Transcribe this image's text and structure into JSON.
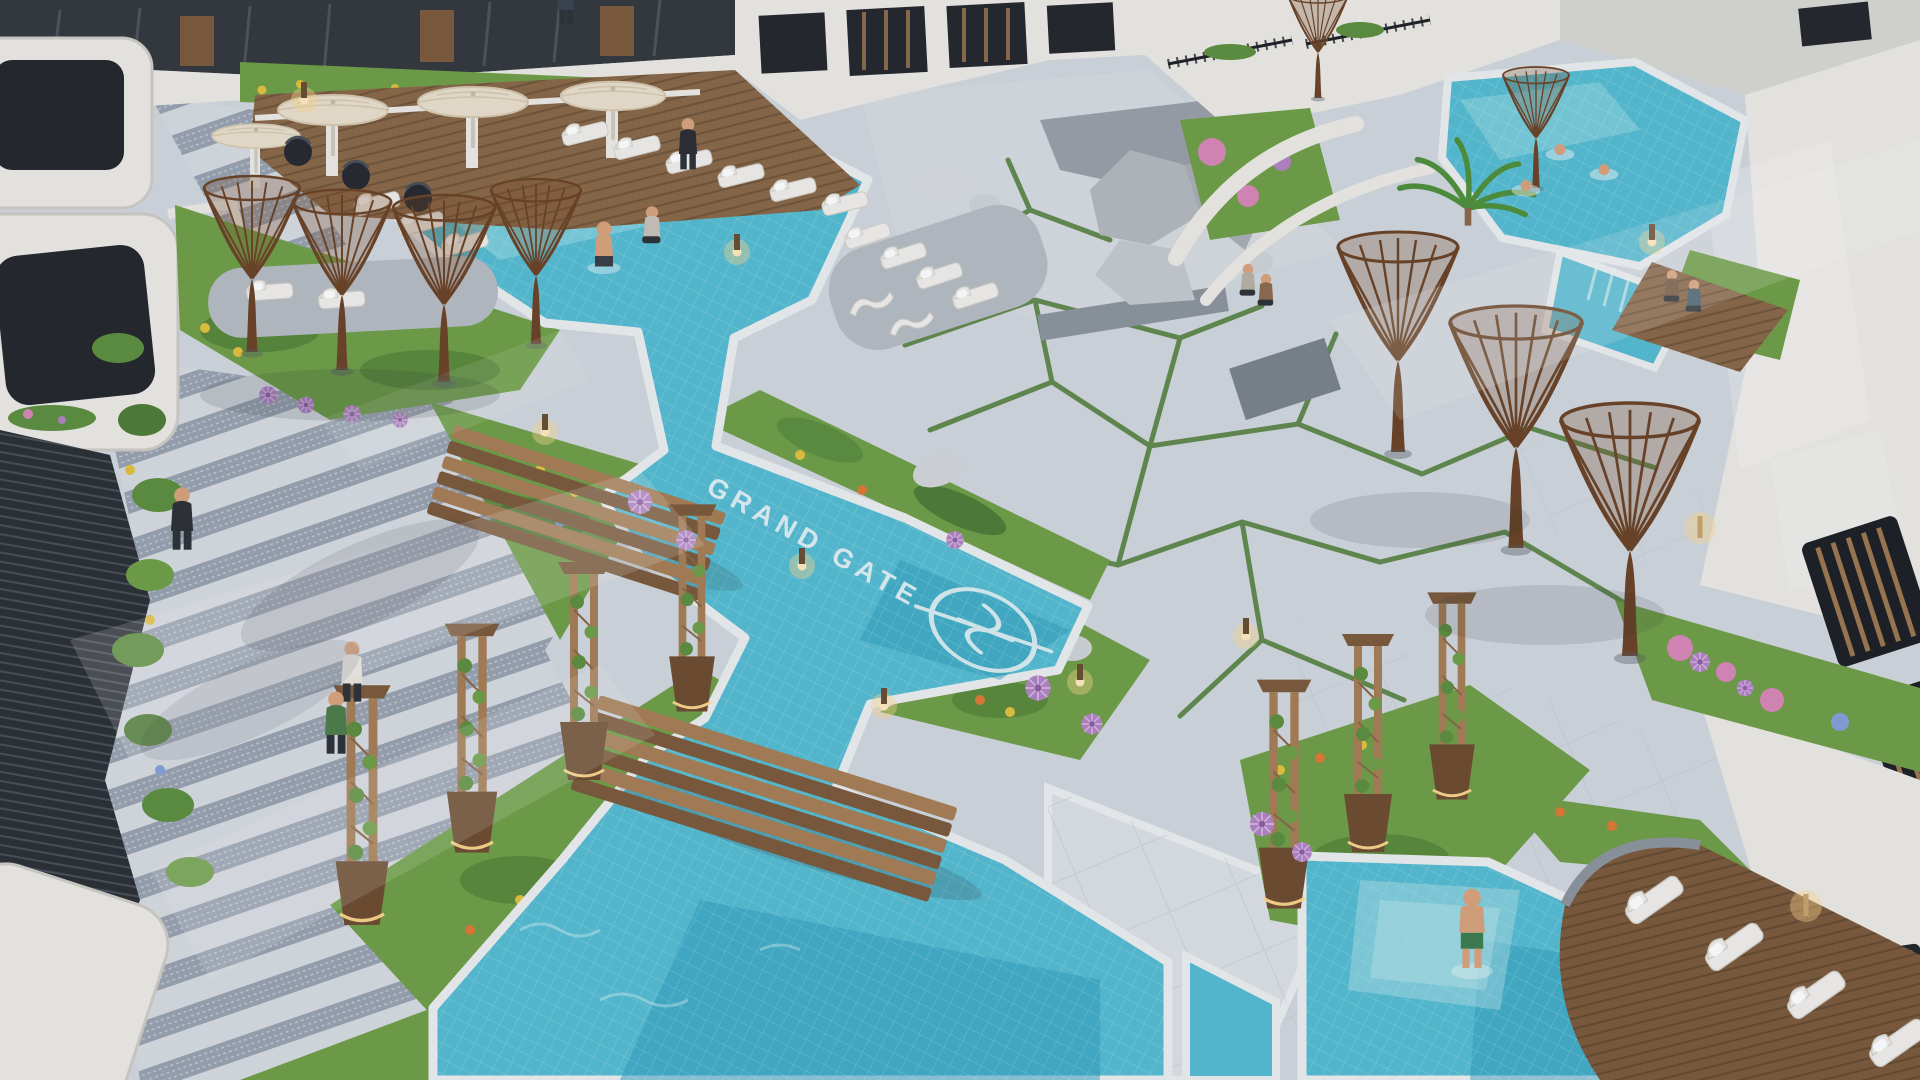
{
  "meta": {
    "type": "architectural-aerial-render",
    "subject": "Residential compound courtyard at dusk with winding turquoise pools, wooden bridges, sculptural wicker trees, lounger decks and white modern apartment buildings"
  },
  "branding": {
    "pool_floor_label": "GRAND GATE",
    "emblem": "circular monogram crest painted on pool floor"
  },
  "palette": {
    "base": "#ccd2da",
    "plaza": "#d2d7de",
    "paver": "#d7dbe1",
    "paver-band": "#99a2b0",
    "coping": "#edeff0",
    "water-light": "#9adbe4",
    "water": "#56bcd2",
    "water-deep": "#2d9cbd",
    "grass": "#6f9f47",
    "grass-dark": "#4f7d36",
    "foliage": "#5d8f3f",
    "wood": "#a67e55",
    "wood-dark": "#7c5a3b",
    "deck": "#8a6847",
    "wicker": "#6b4326",
    "white-bldg": "#eceae6",
    "bldg-shade": "#cfccc6",
    "window": "#24272d",
    "louver": "#9b7850",
    "cream": "#e9dfcc",
    "lounger": "#f1efeb",
    "rock": "#b5b9be",
    "skin": "#d8a37c",
    "flower-purple": "#b383c4",
    "flower-yellow": "#e3c13e",
    "flower-orange": "#dd7a35",
    "flower-pink": "#d887b8",
    "flower-blue": "#86a0d8",
    "lamp-warm": "#ffd98f",
    "ink": "#2e3237",
    "concrete": "#8d949e",
    "concrete-dark": "#7b828c"
  },
  "inventory": {
    "pool_lagoons": 3,
    "wooden_bridges": 2,
    "wicker_supertrees": 9,
    "trellis_planters": 7,
    "sun_loungers": 21,
    "umbrellas": 4,
    "black_wicker_chairs": 3,
    "people": 15,
    "bollard_lights": 8,
    "wall_sconces": 2
  }
}
